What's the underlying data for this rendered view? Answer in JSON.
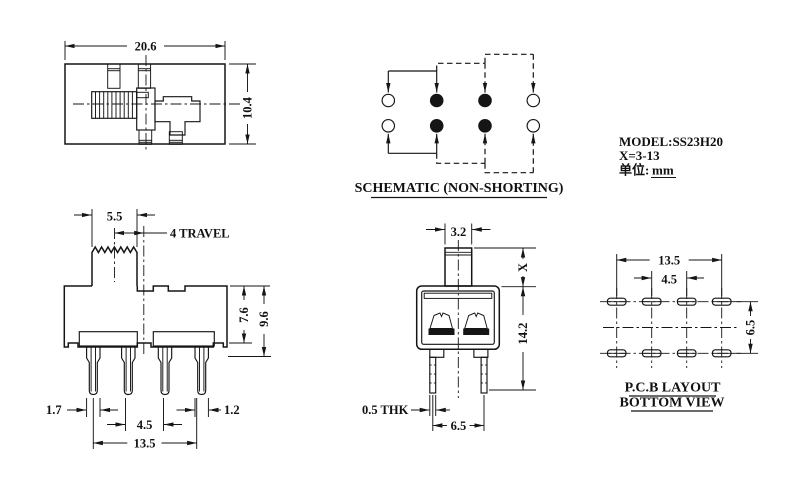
{
  "model_block": {
    "model": "MODEL:SS23H20",
    "x_range": "X=3-13",
    "units_label": "单位:",
    "units_value": "mm"
  },
  "top_view": {
    "width": "20.6",
    "height": "10.4"
  },
  "schematic": {
    "title": "SCHEMATIC (NON-SHORTING)"
  },
  "front_view": {
    "knob_width": "5.5",
    "travel": "4 TRAVEL",
    "body_height": "7.6",
    "total_height": "9.6",
    "pin_width_left": "1.7",
    "pin_pitch_inner": "4.5",
    "pin_width_right": "1.2",
    "pin_span": "13.5"
  },
  "side_view": {
    "knob_width": "3.2",
    "knob_height": "X",
    "overall_height": "14.2",
    "pin_thickness": "0.5 THK",
    "pin_pitch": "6.5"
  },
  "pcb_layout": {
    "title": "P.C.B LAYOUT",
    "subtitle": "BOTTOM VIEW",
    "span": "13.5",
    "inner_pitch": "4.5",
    "row_pitch": "6.5"
  }
}
